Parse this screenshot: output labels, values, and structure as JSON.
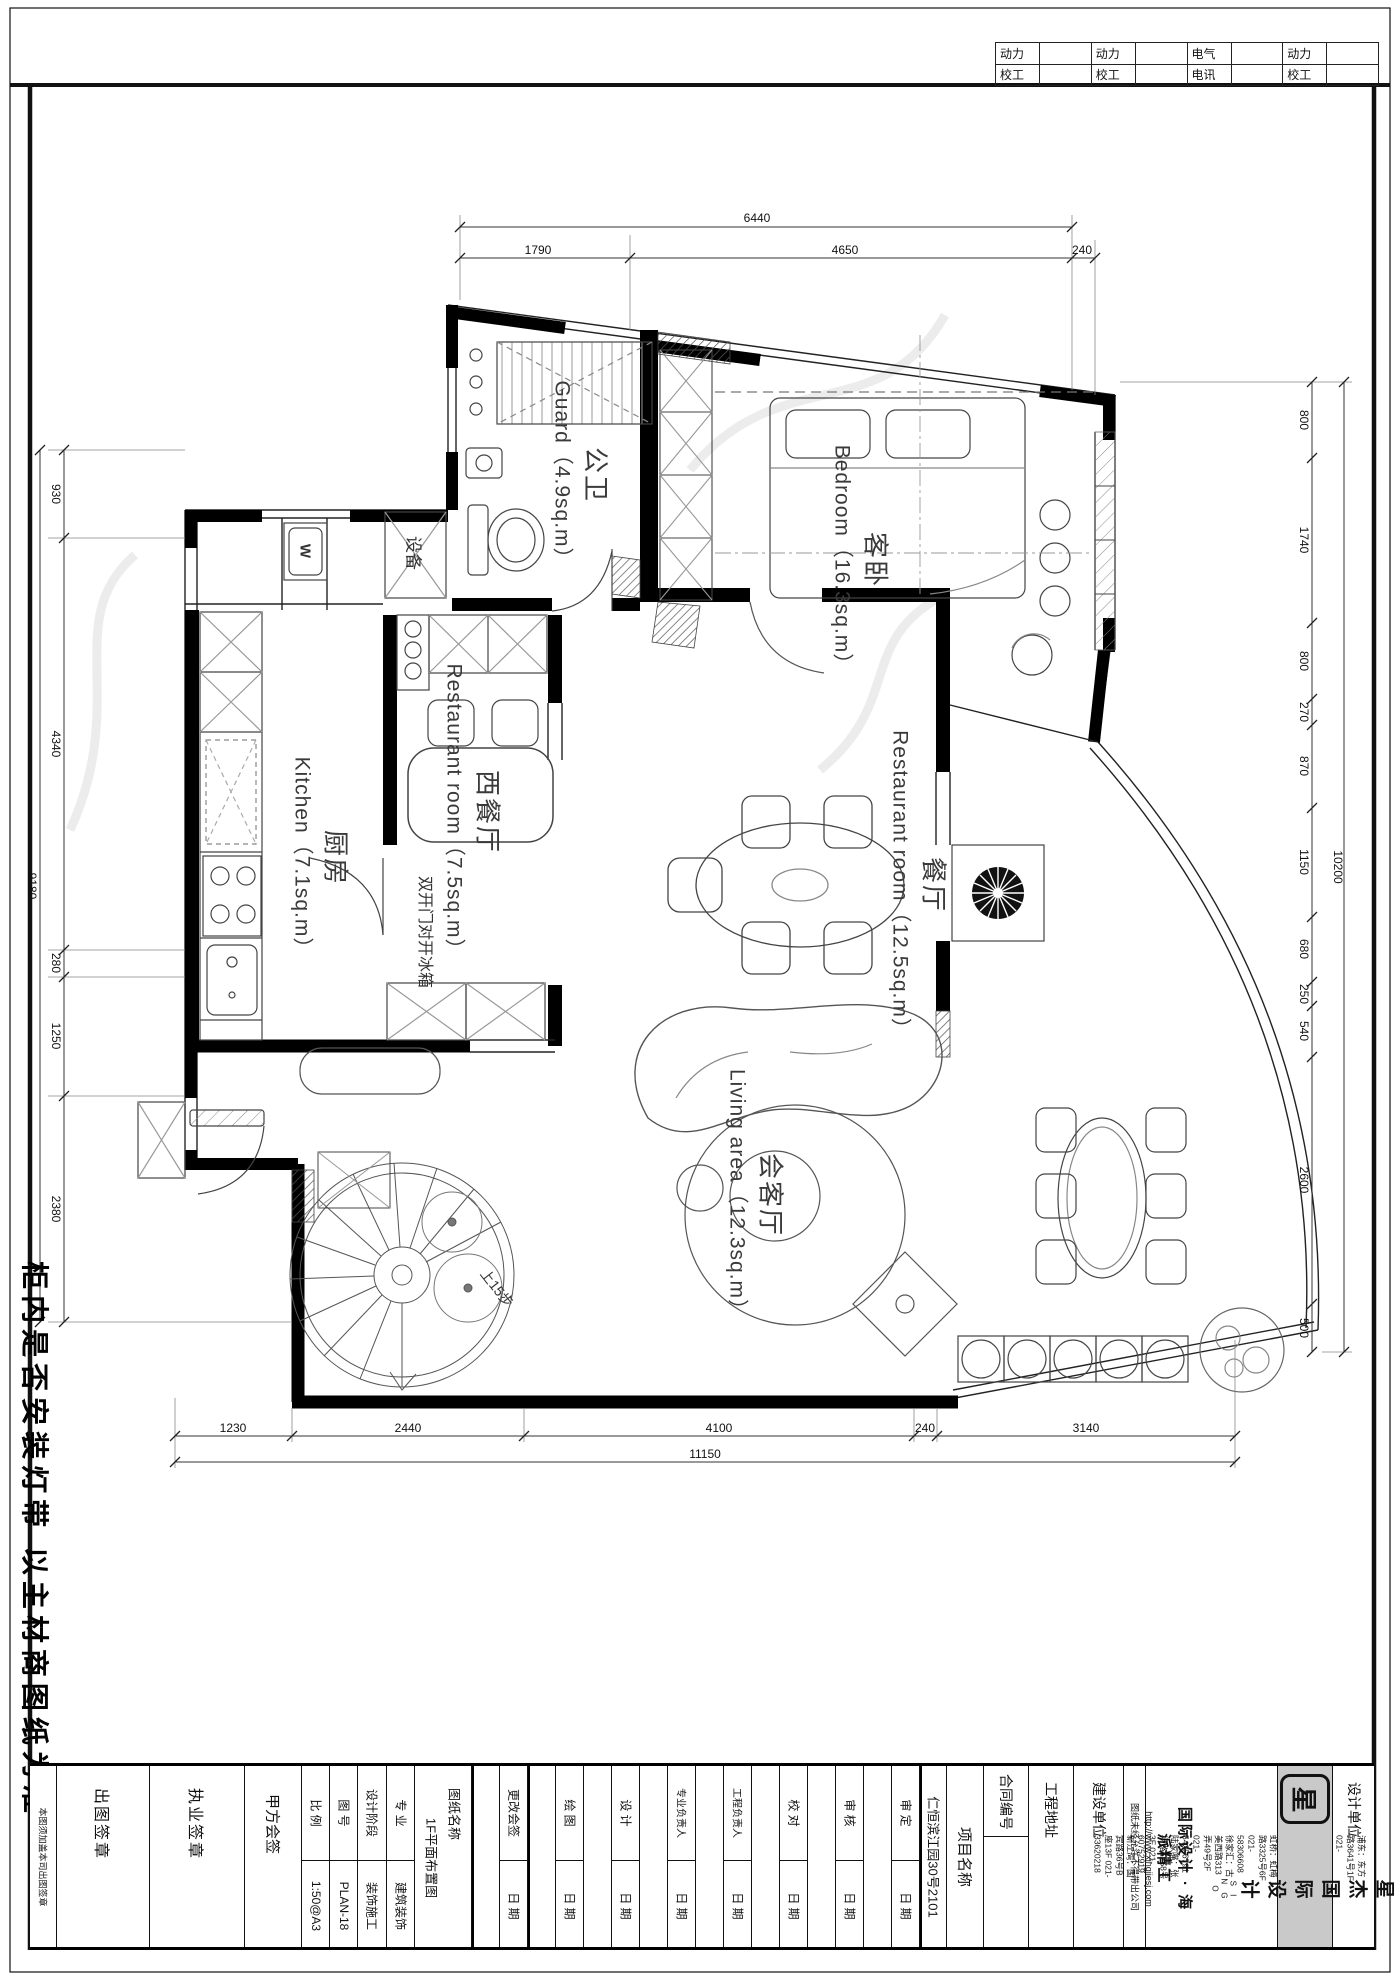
{
  "sheet": {
    "top_table": {
      "groups": [
        {
          "top": "动力",
          "bottom": "校工"
        },
        {
          "top": "动力",
          "bottom": "校工"
        },
        {
          "top": "电气",
          "bottom": "电讯"
        },
        {
          "top": "动力",
          "bottom": "校工"
        }
      ]
    },
    "margin_note": "柜内是否安装灯带 以主材商图纸为准"
  },
  "plan": {
    "rooms": {
      "guard": {
        "en": "Guard（4.9sq.m）",
        "cn": "公卫"
      },
      "bedroom": {
        "en": "Bedroom（16.3sq.m）",
        "cn": "客卧"
      },
      "kitchen": {
        "en": "Kitchen（7.1sq.m）",
        "cn": "厨房"
      },
      "west_dining": {
        "en": "Restaurant room（7.5sq.m）",
        "cn": "西餐厅"
      },
      "dining": {
        "en": "Restaurant room（12.5sq.m）",
        "cn": "餐厅"
      },
      "living": {
        "en": "Living area（12.3sq.m）",
        "cn": "会客厅"
      }
    },
    "annotations": {
      "fridge": "双开门对开冰箱",
      "equipment": "设备",
      "washer": "W",
      "stairs": "上15步"
    },
    "dims": {
      "top_total": "6440",
      "top": [
        "1790",
        "4650",
        "240"
      ],
      "bottom": [
        "1230",
        "2440",
        "4100",
        "240",
        "3140"
      ],
      "bottom_total": "11150",
      "left": [
        "930",
        "4340",
        "280",
        "1250",
        "2380"
      ],
      "left_total": "9180",
      "right": [
        "800",
        "1740",
        "800",
        "270",
        "870",
        "1150",
        "680",
        "250",
        "540",
        "2600",
        "500"
      ],
      "right_total": "10200"
    }
  },
  "titleblock": {
    "stamp_note": "本图须加盖本司出图签章",
    "sign_cells": [
      "出图签章",
      "执业签章",
      "甲方会签"
    ],
    "meta": [
      {
        "label": "比 例",
        "value": "1:50@A3"
      },
      {
        "label": "图 号",
        "value": "PLAN-18"
      },
      {
        "label": "设计阶段",
        "value": "装饰施工"
      },
      {
        "label": "专 业",
        "value": "建筑装饰"
      }
    ],
    "drawing": {
      "label": "图纸名称",
      "value": "1F平面布置图"
    },
    "signoff": [
      {
        "label": "更改会签",
        "date": "日 期"
      },
      {
        "label": "绘 图",
        "date": "日 期"
      },
      {
        "label": "设 计",
        "date": "日 期"
      },
      {
        "label": "专业负责人",
        "date": "日 期"
      },
      {
        "label": "工程负责人",
        "date": "日 期"
      },
      {
        "label": "校 对",
        "date": "日 期"
      },
      {
        "label": "审 核",
        "date": "日 期"
      },
      {
        "label": "审 定",
        "date": "日 期"
      }
    ],
    "project": {
      "label": "项目名称",
      "value": "仁恒滨江园30号2101"
    },
    "contract_label": "合同编号",
    "site_label": "工程地址",
    "client_label": "建设单位",
    "confidential": "图纸未经允许不得带出公司",
    "company": {
      "slogan": "国际设计 · 海派精工",
      "url": "http://www.xingjiesj.com",
      "addresses": [
        "浦东：东方路3641号1F 021-60458978",
        "普陀：真光路1219号22F 021-61170911",
        "虹桥：虹梅路3325号6F 021-58306608",
        "徐家汇：古美西路313弄49号2F 021-54256791",
        "陆家嘴：张杨路1258号3F 021-60752919",
        "新江湾：国宾路36号B座13F 021-33620218"
      ],
      "brand_cn": "星杰国际设计",
      "brand_en": "S I N G O",
      "unit_label": "设计单位",
      "seal": "星"
    }
  }
}
